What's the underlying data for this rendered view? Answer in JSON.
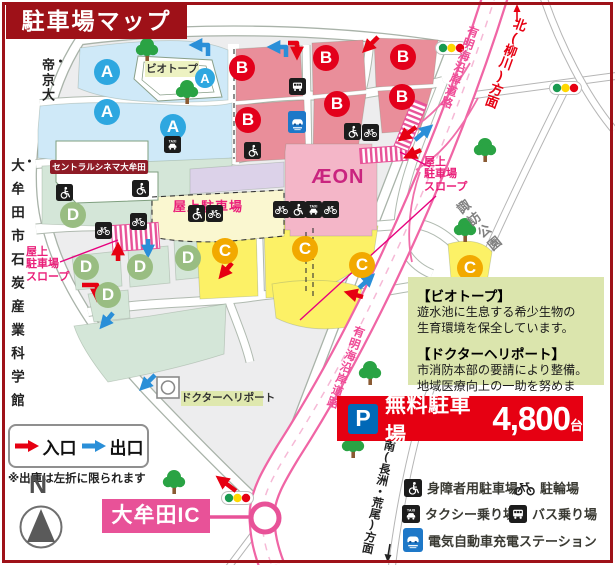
{
  "title": "駐車場マップ",
  "zones": {
    "a": "A",
    "b": "B",
    "c": "C",
    "d": "D"
  },
  "facilities": {
    "biotope": "ビオトープ",
    "cinema": "セントラルシネマ大牟田",
    "aeon": "ÆON",
    "rooftop_parking": "屋上駐車場",
    "rooftop_slope": "屋上\n駐車場\nスロープ",
    "tire_shop": "ダイヤ館",
    "workman": "Workman",
    "workman_colors": "Colors",
    "universal_home": "ユニバーサル ホーム",
    "heliport": "ドクターヘリポート",
    "interchange": "大牟田IC"
  },
  "directions": {
    "north_road": "北(柳川)方面",
    "south_road": "南(長洲・荒尾)方面",
    "ariake_road": "有明海沿岸道路",
    "suwa_park": "諏訪公園",
    "teikyo_univ": "帝京大",
    "coal_museum": "大牟田市石炭産業科学館"
  },
  "legend": {
    "entrance": "入口",
    "exit": "出口",
    "note": "※出庫は左折に限られます",
    "north": "N"
  },
  "banner": {
    "p": "P",
    "label": "無料駐車場",
    "count": "4,800",
    "unit": "台"
  },
  "info_box": {
    "biotope_title": "【ビオトープ】",
    "biotope_body": "遊水池に生息する希少生物の\n生育環境を保全しています。",
    "heliport_title": "【ドクターヘリポート】",
    "heliport_body": "市消防本部の要請により整備。\n地域医療向上の一助を努めます。"
  },
  "icon_legend": {
    "disabled": "身障者用駐車場",
    "bicycle": "駐輪場",
    "taxi": "タクシー乗り場",
    "bus": "バス乗り場",
    "ev": "電気自動車充電ステーション"
  },
  "colors": {
    "frame_red": "#9e1118",
    "entrance_red": "#e60012",
    "exit_blue": "#2a8fd8",
    "expressway_pink": "#ee5a9b",
    "ic_pink": "#e85298",
    "p_blue": "#0068b7",
    "zone_a_blue": "#2ea7e0",
    "zone_b_red": "#e3001b",
    "zone_c_orange": "#f2a900",
    "zone_d_green": "#99bd82"
  }
}
